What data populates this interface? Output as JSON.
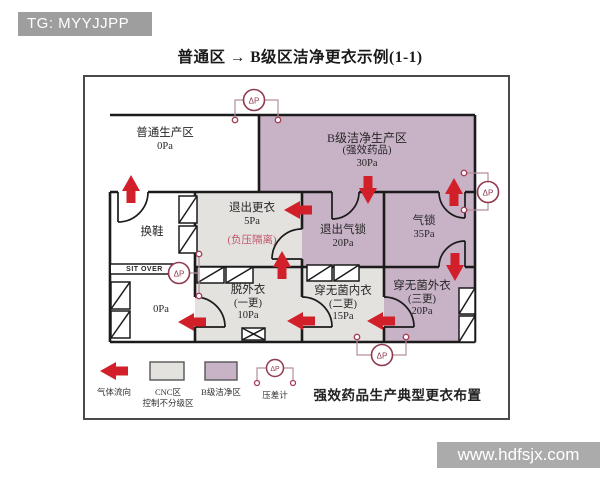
{
  "badge": {
    "label": "TG: MYYJJPP"
  },
  "title": "普通区 → B级区洁净更衣示例(1-1)",
  "plan": {
    "gauge_label": "ΔP",
    "bench_label": "SIT OVER",
    "rooms": {
      "general_production": {
        "name": "普通生产区",
        "pressure": "0Pa"
      },
      "grade_b_production": {
        "name": "B级洁净生产区",
        "subtitle": "(强效药品)",
        "pressure": "30Pa"
      },
      "shoe_change": {
        "name": "换鞋"
      },
      "exit_gowning": {
        "name": "退出更衣",
        "pressure": "5Pa",
        "note": "(负压隔离)"
      },
      "exit_airlock": {
        "name": "退出气锁",
        "pressure": "20Pa"
      },
      "airlock": {
        "name": "气锁",
        "pressure": "35Pa"
      },
      "corridor": {
        "pressure": "0Pa"
      },
      "remove_outerwear": {
        "name": "脱外衣",
        "subtitle": "(一更)",
        "pressure": "10Pa"
      },
      "sterile_inner_gown": {
        "name": "穿无菌内衣",
        "subtitle": "(二更)",
        "pressure": "15Pa"
      },
      "sterile_outer_gown": {
        "name": "穿无菌外衣",
        "subtitle": "(三更)",
        "pressure": "20Pa"
      }
    },
    "legend": {
      "airflow": "气体流向",
      "cnc_line1": "CNC区",
      "cnc_line2": "控制不分级区",
      "grade_b": "B级洁净区",
      "gauge": "压差计"
    },
    "caption": "强效药品生产典型更衣布置"
  },
  "watermark": {
    "label": "www.hdfsjx.com"
  },
  "colors": {
    "grade_b_fill": "#c8b2c6",
    "cnc_fill": "#e3e2df",
    "airflow_red": "#d1202a",
    "gauge_maroon": "#8f3a4e",
    "badge_gray": "#9e9e9e",
    "banner_gray": "#ababab"
  }
}
